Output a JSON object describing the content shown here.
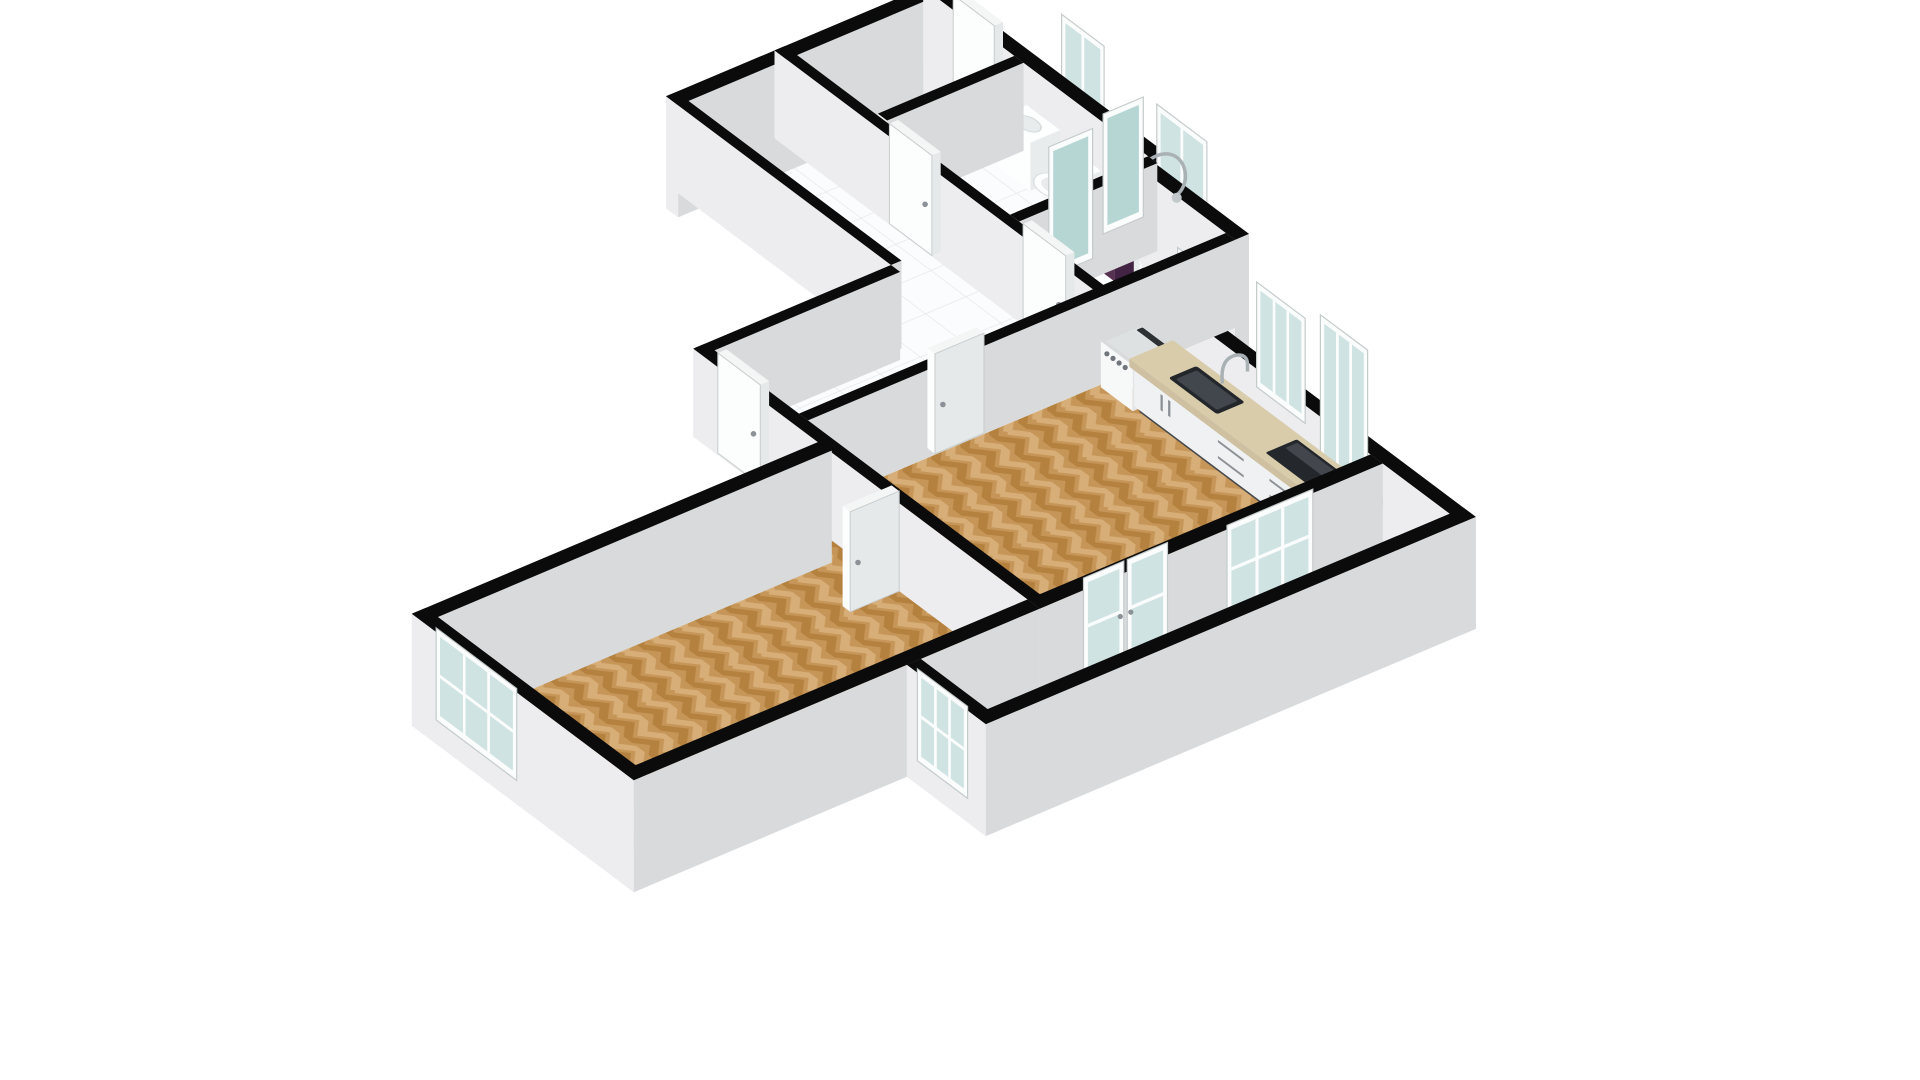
{
  "page": {
    "background": "#ffffff",
    "title": "3D isometric floor plan"
  },
  "floorplan": {
    "view": "isometric-3d",
    "rooms": [
      {
        "id": "entrance-hall",
        "name": "Entrance hall",
        "floor": "white tile"
      },
      {
        "id": "bathroom",
        "name": "Bathroom",
        "floor": "white tile",
        "fixtures": [
          "toilet",
          "vanity basin"
        ]
      },
      {
        "id": "hallway",
        "name": "Hallway",
        "floor": "white tile"
      },
      {
        "id": "shower-room",
        "name": "Shower room",
        "floor": "white tile",
        "fixtures": [
          "shower",
          "towel rail",
          "purple towel"
        ]
      },
      {
        "id": "kitchen-living-room",
        "name": "Kitchen / living room",
        "floor": "herringbone parquet",
        "fixtures": [
          "kitchen counter",
          "sink",
          "faucet",
          "cooktop",
          "washing machine",
          "cabinet handles"
        ]
      },
      {
        "id": "bedroom",
        "name": "Bedroom",
        "floor": "herringbone parquet"
      },
      {
        "id": "balcony",
        "name": "Balcony",
        "floor": "pale ceramic tile"
      }
    ],
    "openings": {
      "entrance_door": 1,
      "interior_doors": 5,
      "french_doors": 1,
      "sliding_windows": 3,
      "windows": 7
    },
    "colors": {
      "wallTop": "#0b0b0b",
      "wallLight": "#ededef",
      "wallShade": "#d8dadb",
      "floorTileBg": "#fbfcfd",
      "floorTileLine": "#e4e7ea",
      "parquetBase": "#c69659",
      "parquetDark": "#b5813f",
      "parquetLight": "#d8ae78",
      "balconyBg": "#f2ecea",
      "balconyLine": "#ded4d1",
      "counterTop": "#d9ccab",
      "counterEdge": "#cec0a0",
      "counterEdgeDark": "#c2b494",
      "cabinetFace": "#f0f1f2",
      "cabinetShade": "#dddfe0",
      "plinth": "#46494c",
      "sinkOuter": "#23272b",
      "sinkInner": "#41474d",
      "steel": "#aab1b5",
      "cooktop": "#24272c",
      "cooktopSheen": "#43474d",
      "doorFace": "#fcfdfd",
      "doorShade": "#e6e9e9",
      "doorTop": "#f4f5f5",
      "doorEdge": "#c7cccc",
      "handle": "#8b9196",
      "frame": "#fbfcfc",
      "frameEdge": "#c5cbcb",
      "glass": "#c7dedd",
      "glassTeal": "#a9cfcd",
      "towel": "#573150",
      "towelShade": "#432344",
      "applianceTop": "#dde1e2",
      "applianceDark": "#2e3134",
      "knob": "#70767b",
      "white": "#fdfefe",
      "whiteShade": "#e9eced"
    }
  }
}
